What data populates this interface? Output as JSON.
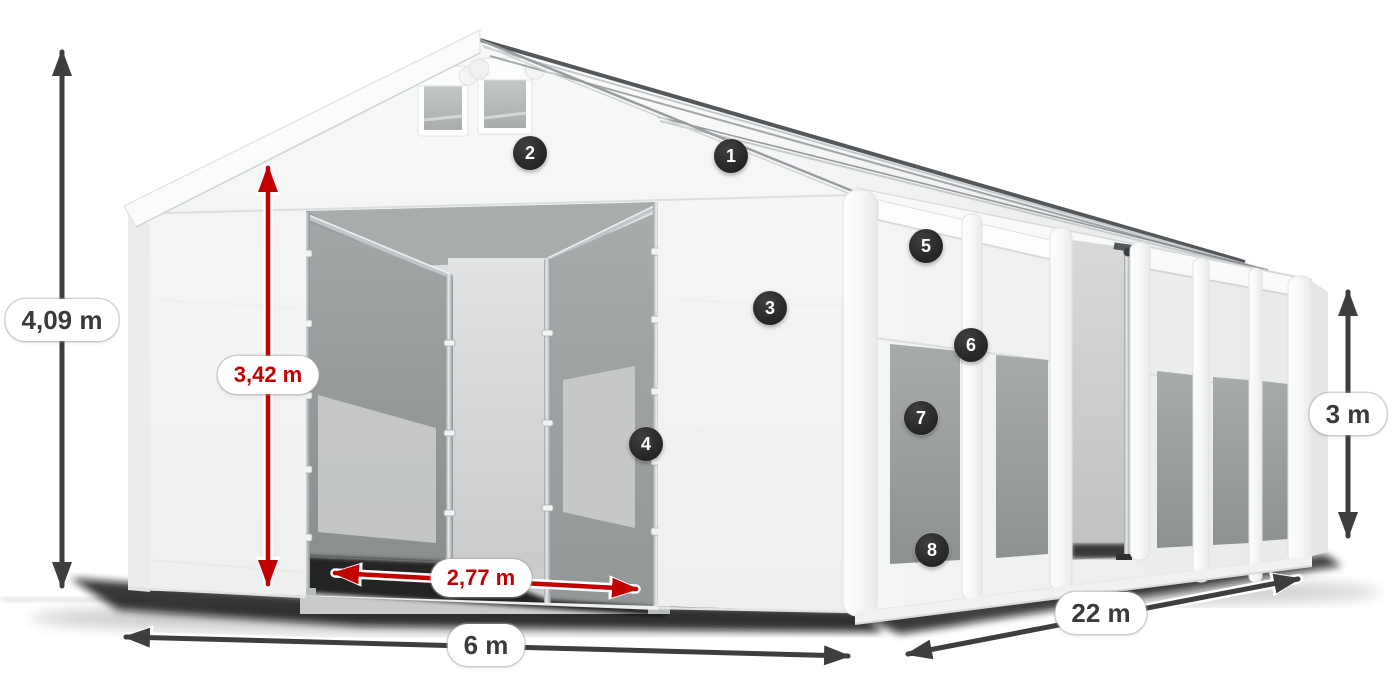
{
  "diagram": {
    "title": "Storage tent dimension diagram",
    "background": "#ffffff",
    "colors": {
      "accent_red": "#c30000",
      "arrow_dark": "#3e3e3e",
      "badge_bg": "#2a2a2a",
      "badge_text": "#ffffff",
      "label_bg": "#ffffff",
      "label_text_dark": "#3a3a3a",
      "tent_white": "#f4f5f5",
      "window_gray": "#999c9e",
      "shadow": "#0a0a0a"
    },
    "dimension_labels": {
      "total_height": "4,09 m",
      "entrance_height": "3,42 m",
      "entrance_width": "2,77 m",
      "tent_width": "6 m",
      "tent_length": "22 m",
      "side_height": "3 m"
    },
    "callouts": [
      {
        "number": "1"
      },
      {
        "number": "2"
      },
      {
        "number": "3"
      },
      {
        "number": "4"
      },
      {
        "number": "5"
      },
      {
        "number": "6"
      },
      {
        "number": "7"
      },
      {
        "number": "8"
      }
    ]
  }
}
